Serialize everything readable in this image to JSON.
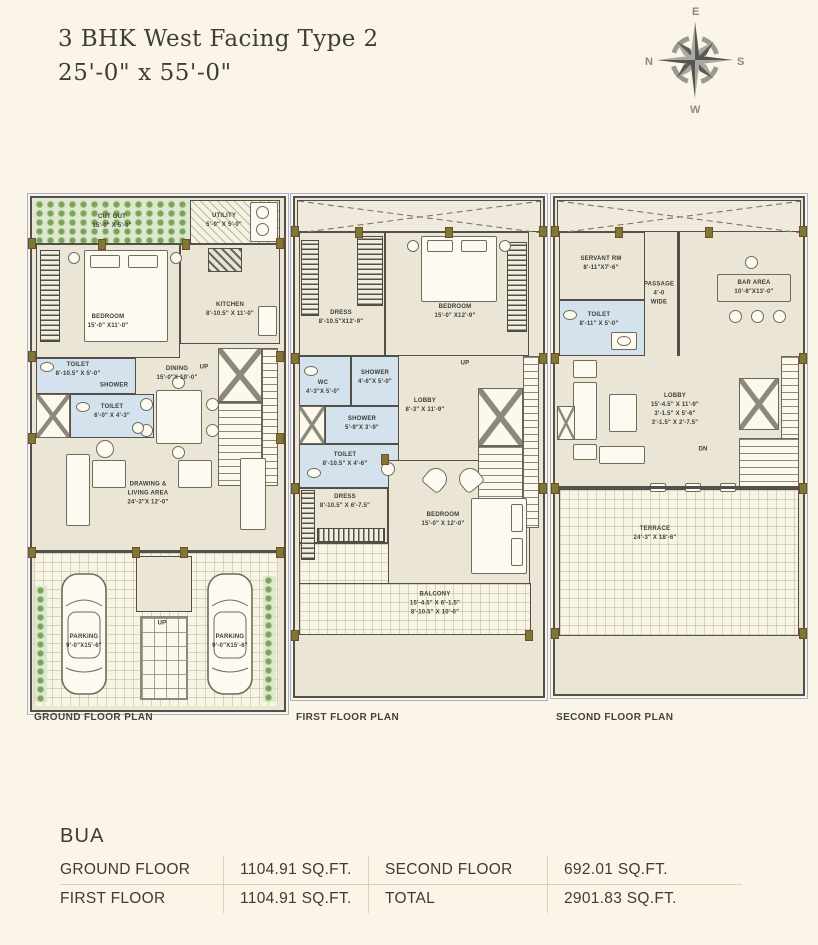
{
  "title": {
    "line1": "3 BHK West Facing Type 2",
    "line2": "25'-0\" x 55'-0\""
  },
  "compass": {
    "east": "E",
    "south": "S",
    "west": "W",
    "north": "N"
  },
  "ground": {
    "caption": "GROUND FLOOR PLAN",
    "cutout": {
      "name": "CUT OUT",
      "dims": "15'-0\" X 5'-0\""
    },
    "utility": {
      "name": "UTILITY",
      "dims": "5'-0\" X 5'-0\""
    },
    "bedroom": {
      "name": "BEDROOM",
      "dims": "15'-0\" X11'-0\""
    },
    "kitchen": {
      "name": "KITCHEN",
      "dims": "8'-10.5\" X 11'-0\""
    },
    "dining": {
      "name": "DINING",
      "dims": "15'-0\"X 10'-0\""
    },
    "stairs_up": "UP",
    "toilet1": {
      "name": "TOILET",
      "dims": "8'-10.5\" X 5'-0\""
    },
    "shower": "SHOWER",
    "toilet2": {
      "name": "TOILET",
      "dims": "6'-0\" X 4'-3\""
    },
    "living": {
      "name1": "DRAWING &",
      "name2": "LIVING AREA",
      "dims": "24'-3\"X 12'-0\""
    },
    "parking_left": {
      "name": "PARKING",
      "dims": "9'-0\"X15'-6\""
    },
    "parking_right": {
      "name": "PARKING",
      "dims": "9'-0\"X15'-6\""
    },
    "entry_up": "UP"
  },
  "first": {
    "caption": "FIRST FLOOR PLAN",
    "dress1": {
      "name": "DRESS",
      "dims": "8'-10.5\"X12'-9\""
    },
    "bedroom1": {
      "name": "BEDROOM",
      "dims": "15'-0\" X12'-9\""
    },
    "wc": {
      "name": "WC",
      "dims": "4'-3\"X 5'-0\""
    },
    "shower1": {
      "name": "SHOWER",
      "dims": "4'-6\"X 5'-0\""
    },
    "shower2": {
      "name": "SHOWER",
      "dims": "5'-9\"X 3'-9\""
    },
    "toilet": {
      "name": "TOILET",
      "dims": "8'-10.5\" X 4'-6\""
    },
    "lobby": {
      "name": "LOBBY",
      "dims": "8'-3\" X 11'-9\""
    },
    "stairs_up": "UP",
    "dress2": {
      "name": "DRESS",
      "dims": "8'-10.5\" X 6'-7.5\""
    },
    "bedroom2": {
      "name": "BEDROOM",
      "dims": "15'-0\" X 12'-0\""
    },
    "balcony": {
      "name": "BALCONY",
      "dims1": "15'-4.5\" X 6'-1.5\"",
      "dims2": "8'-10.5\" X 10'-0\""
    }
  },
  "second": {
    "caption": "SECOND FLOOR PLAN",
    "servant": {
      "name": "SERVANT RM",
      "dims": "8'-11\"X7'-6\""
    },
    "passage": {
      "name": "PASSAGE",
      "dims1": "4'-0",
      "dims2": "WIDE"
    },
    "toilet": {
      "name": "TOILET",
      "dims": "8'-11\" X 5'-0\""
    },
    "bar": {
      "name": "BAR AREA",
      "dims": "10'-8\"X13'-0\""
    },
    "lobby": {
      "name": "LOBBY",
      "dims1": "15'-4.5\" X 11'-9\"",
      "dims2": "3'-1.5\" X 5'-6\"",
      "dims3": "3'-1.5\" X 2'-7.5\""
    },
    "stairs_dn": "DN",
    "terrace": {
      "name": "TERRACE",
      "dims": "24'-3\" X 18'-6\""
    }
  },
  "bua": {
    "heading": "BUA",
    "rows": [
      {
        "label1": "GROUND FLOOR",
        "value1": "1104.91 SQ.FT.",
        "label2": "SECOND FLOOR",
        "value2": "692.01 SQ.FT."
      },
      {
        "label1": "FIRST FLOOR",
        "value1": "1104.91 SQ.FT.",
        "label2": "TOTAL",
        "value2": "2901.83 SQ.FT."
      }
    ]
  }
}
